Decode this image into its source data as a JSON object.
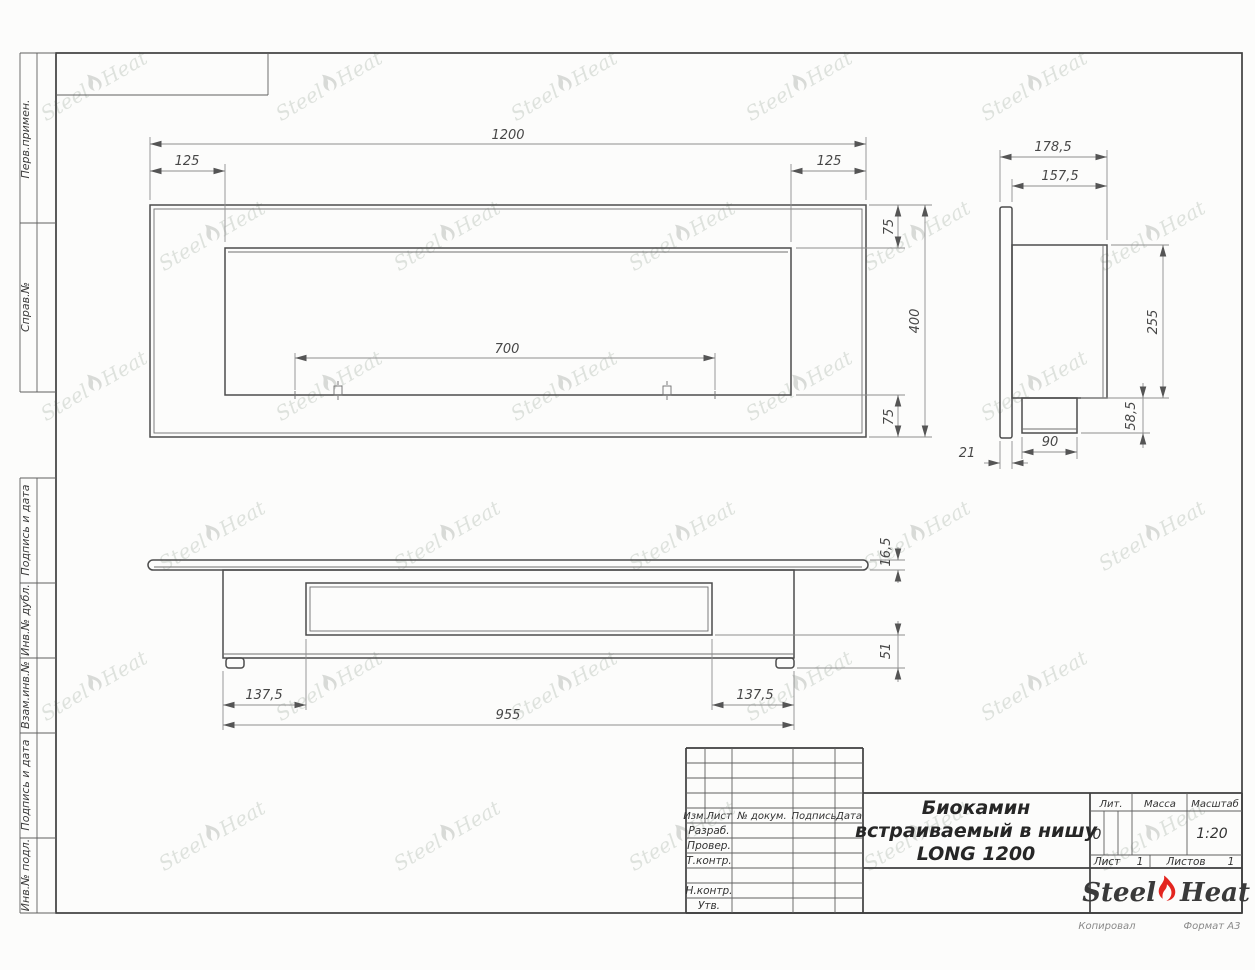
{
  "watermark": {
    "steel": "Steel",
    "heat": "Heat"
  },
  "sidebar": {
    "labels": [
      "Перв.примен.",
      "Справ.№",
      "Подпись и дата",
      "Инв.№ дубл.",
      "Взам.инв.№",
      "Подпись и дата",
      "Инв.№ подл."
    ]
  },
  "dims": {
    "front": {
      "width": "1200",
      "offset_left": "125",
      "offset_right": "125",
      "margin_top": "75",
      "margin_bottom": "75",
      "height": "400",
      "burner": "700"
    },
    "side": {
      "depth_overall": "178,5",
      "depth_body": "157,5",
      "body_height": "255",
      "burner_height": "58,5",
      "burner_width": "90",
      "flange": "21"
    },
    "plan": {
      "plate": "16,5",
      "lower": "51",
      "inset_left": "137,5",
      "inset_right": "137,5",
      "body_width": "955"
    }
  },
  "stamp": {
    "header_cols": [
      "Изм.",
      "Лист",
      "№ докум.",
      "Подпись",
      "Дата"
    ],
    "row_labels": [
      "Разраб.",
      "Провер.",
      "Т.контр.",
      "Н.контр.",
      "Утв."
    ],
    "title_lines": [
      "Биокамин",
      "встраиваемый в нишу",
      "LONG 1200"
    ],
    "lit_label": "Лит.",
    "lit_value": "0",
    "mass_label": "Масса",
    "scale_label": "Масштаб",
    "scale_value": "1:20",
    "sheet_label": "Лист",
    "sheet_value": "1",
    "sheets_label": "Листов",
    "sheets_value": "1",
    "logo": {
      "steel": "Steel",
      "heat": "Heat"
    },
    "footer_copy": "Копировал",
    "footer_format": "Формат А3"
  }
}
